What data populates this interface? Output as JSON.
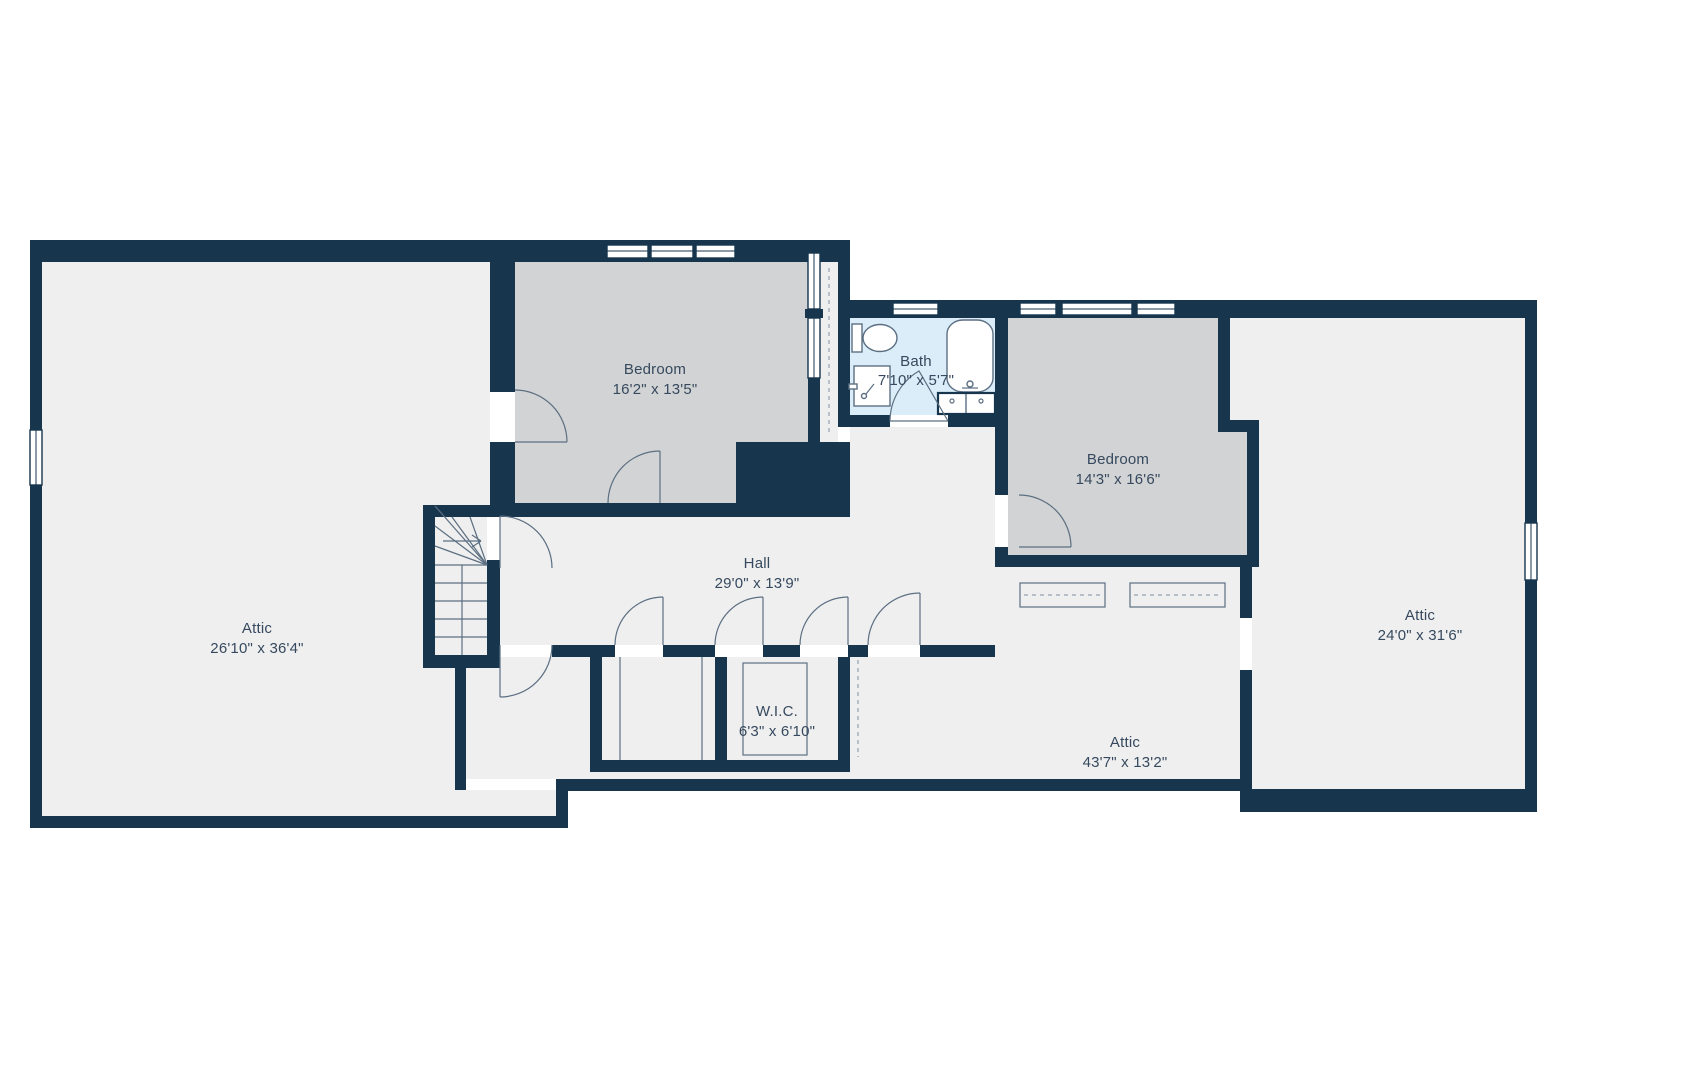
{
  "title": "Second floor plan",
  "colors": {
    "background": "#ffffff",
    "wall": "#17364e",
    "floor": "#efefef",
    "room_gray": "#d2d3d4",
    "bath_blue": "#daedf8",
    "line": "#5c6f82",
    "text": "#36495e"
  },
  "rooms": [
    {
      "id": "attic-left",
      "name": "Attic",
      "dims": "26'10\" x 36'4\""
    },
    {
      "id": "bedroom-left",
      "name": "Bedroom",
      "dims": "16'2\" x 13'5\""
    },
    {
      "id": "bath",
      "name": "Bath",
      "dims": "7'10\" x 5'7\""
    },
    {
      "id": "bedroom-right",
      "name": "Bedroom",
      "dims": "14'3\" x 16'6\""
    },
    {
      "id": "hall",
      "name": "Hall",
      "dims": "29'0\" x 13'9\""
    },
    {
      "id": "wic",
      "name": "W.I.C.",
      "dims": "6'3\" x 6'10\""
    },
    {
      "id": "attic-bottom",
      "name": "Attic",
      "dims": "43'7\" x 13'2\""
    },
    {
      "id": "attic-right",
      "name": "Attic",
      "dims": "24'0\" x 31'6\""
    }
  ],
  "fixtures": [
    "toilet",
    "shower",
    "bathtub",
    "vanity-sink",
    "staircase"
  ],
  "symbols": [
    "door-arc",
    "window",
    "stair-direction-arrow",
    "storage-outline"
  ]
}
